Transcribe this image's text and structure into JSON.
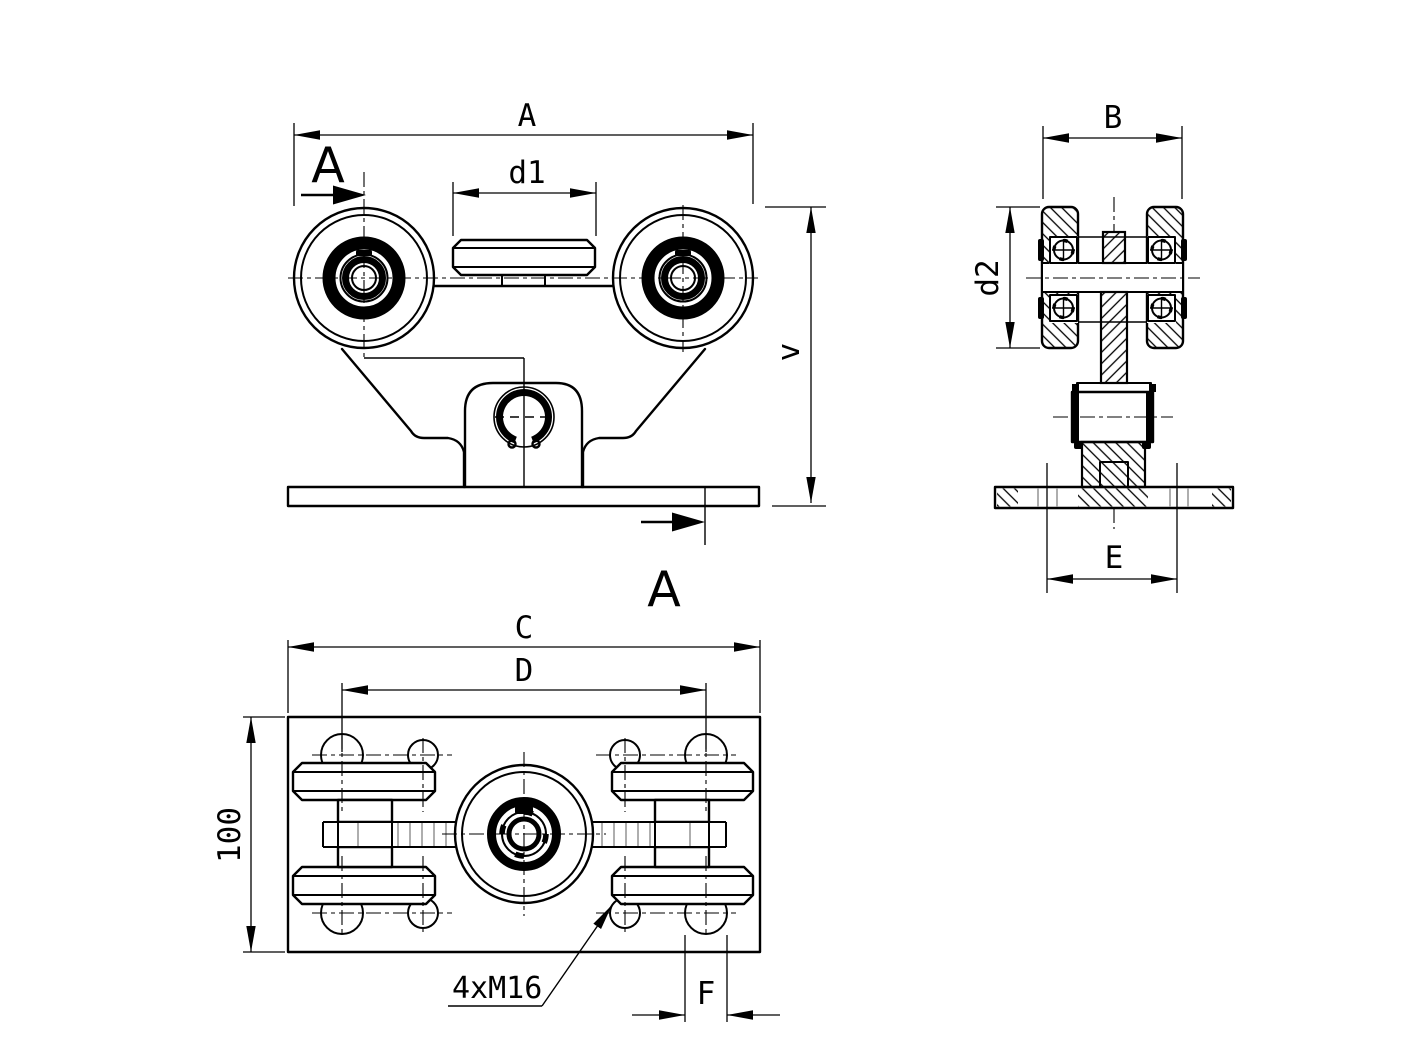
{
  "drawing_type": "technical-drawing-gate-trolley",
  "labels": {
    "overall_width": "A",
    "section": "A",
    "guide_width": "d1",
    "height": "v",
    "side_width": "B",
    "wheel_diameter": "d2",
    "base_hole_spacing": "E",
    "plate_length": "C",
    "hole_spacing_length": "D",
    "plate_width": "100",
    "hole_diameter": "F",
    "thread_note": "4xM16"
  },
  "colors": {
    "background": "#ffffff",
    "line": "#000000",
    "hidden_line": "#9a9a9a"
  }
}
